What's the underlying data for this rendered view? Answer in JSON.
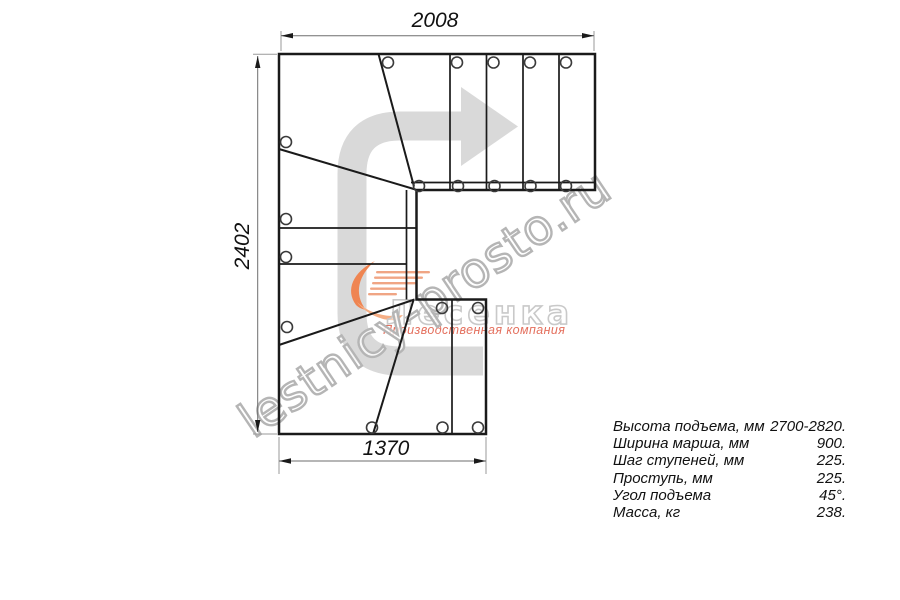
{
  "drawing": {
    "dimensions": {
      "top": "2008",
      "left": "2402",
      "bottom": "1370"
    }
  },
  "specs": {
    "rows": [
      {
        "label": "Высота подъема, мм",
        "value": "2700-2820."
      },
      {
        "label": "Ширина марша, мм",
        "value": "900."
      },
      {
        "label": "Шаг ступеней, мм",
        "value": "225."
      },
      {
        "label": "Проступь, мм",
        "value": "225."
      },
      {
        "label": "Угол подъема",
        "value": "45°."
      },
      {
        "label": "Масса, кг",
        "value": "238."
      }
    ]
  },
  "watermark": {
    "site": "lestnicy-prosto.ru",
    "brand": "Лесенка",
    "tagline": "Производственная компания"
  },
  "colors": {
    "line_black": "#1a1a1a",
    "brand_orange": "#ef8552",
    "tagline_salmon": "#e4705e",
    "watermark_gray": "#b5b5b5",
    "arrow_gray": "#d9d9d9"
  }
}
